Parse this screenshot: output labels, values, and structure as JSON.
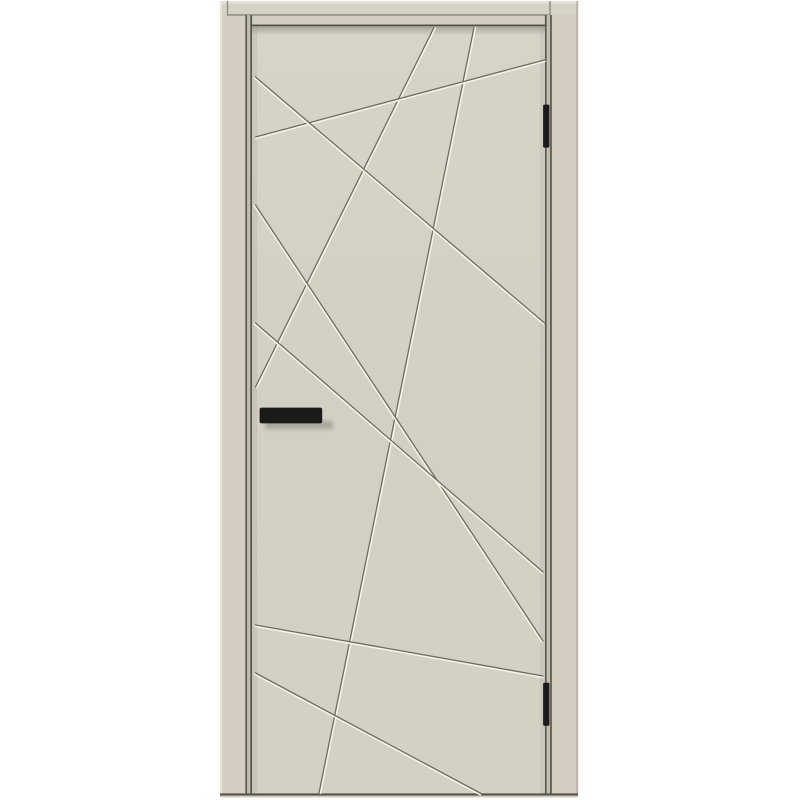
{
  "scene": {
    "background": "#ffffff",
    "palette": {
      "frame_face": "#d3cec1",
      "header_face": "#d7d2c6",
      "frame_highlight": "#e6e2d7",
      "frame_outer_shadow": "#b9b5a9",
      "joint_line": "#8d897e",
      "reveal_light": "#c0bcb0",
      "edge_dark": "#57544b",
      "panel_shade": "#96928a",
      "groove_dark": "#6f6b60",
      "groove_light": "#f6f3e9",
      "hardware_black": "#1a1a18",
      "bottom_strip": "#cec9bd"
    },
    "rects": [
      {
        "name": "background",
        "x": 0,
        "y": 0,
        "w": 800,
        "h": 800,
        "fill": "#ffffff"
      },
      {
        "name": "frame-casing-base",
        "x": 220,
        "y": 1,
        "w": 358,
        "h": 795,
        "fill": "frame_face"
      },
      {
        "name": "header-face",
        "x": 222,
        "y": 1,
        "w": 354,
        "h": 13.3,
        "fill": "header_face"
      },
      {
        "name": "frame-top-highlight",
        "x": 220,
        "y": 1,
        "w": 358,
        "h": 2.5,
        "fill": "frame_highlight"
      },
      {
        "name": "frame-left-highlight",
        "x": 220,
        "y": 1,
        "w": 2,
        "h": 795,
        "fill": "frame_highlight"
      },
      {
        "name": "frame-right-outer-shadow",
        "x": 576.3,
        "y": 1,
        "w": 1.9,
        "h": 795,
        "fill": "frame_outer_shadow"
      },
      {
        "name": "casing-joint-line",
        "x": 227,
        "y": 14.2,
        "w": 322.8,
        "h": 1.5,
        "fill": "joint_line"
      },
      {
        "name": "casing-joint-left-vertical",
        "x": 226.8,
        "y": 1,
        "w": 1.3,
        "h": 14.7,
        "fill": "joint_line"
      },
      {
        "name": "casing-joint-right-vertical",
        "x": 549.3,
        "y": 1,
        "w": 1.4,
        "h": 14.7,
        "fill": "joint_line"
      },
      {
        "name": "left-frame-stop-line",
        "x": 245.4,
        "y": 15,
        "w": 1.6,
        "h": 779,
        "fill": "edge_dark"
      },
      {
        "name": "left-reveal",
        "x": 247,
        "y": 15,
        "w": 3.3,
        "h": 779,
        "fill": "reveal_light"
      },
      {
        "name": "door-left-edge-line",
        "x": 250.3,
        "y": 15,
        "w": 1.8,
        "h": 779,
        "fill": "edge_dark"
      },
      {
        "name": "door-right-edge-line",
        "x": 544.9,
        "y": 15,
        "w": 1.8,
        "h": 779,
        "fill": "edge_dark"
      },
      {
        "name": "right-reveal",
        "x": 546.7,
        "y": 15,
        "w": 3.4,
        "h": 779,
        "fill": "reveal_light"
      },
      {
        "name": "right-frame-stop-line",
        "x": 550.1,
        "y": 15,
        "w": 1.7,
        "h": 779,
        "fill": "edge_dark"
      },
      {
        "name": "door-top-edge-line",
        "x": 250.3,
        "y": 24.5,
        "w": 296.4,
        "h": 1.9,
        "fill": "edge_dark"
      },
      {
        "name": "door-panel",
        "x": 252.1,
        "y": 26.4,
        "w": 292.8,
        "h": 767.2,
        "fill": "url(#panelGrad)"
      },
      {
        "name": "door-top-inner-shadow",
        "x": 252.1,
        "y": 26.4,
        "w": 292.8,
        "h": 9,
        "fill": "url(#topShadowGrad)"
      },
      {
        "name": "door-left-inner-shade",
        "x": 252.1,
        "y": 26.4,
        "w": 5,
        "h": 767.2,
        "fill": "panel_shade",
        "opacity": 0.18
      },
      {
        "name": "door-right-inner-shade",
        "x": 539.9,
        "y": 26.4,
        "w": 5,
        "h": 767.2,
        "fill": "panel_shade",
        "opacity": 0.15
      },
      {
        "name": "bottom-edge-line",
        "x": 220,
        "y": 793.4,
        "w": 358,
        "h": 2.2,
        "fill": "edge_dark"
      },
      {
        "name": "bottom-light-strip",
        "x": 220,
        "y": 795.6,
        "w": 358,
        "h": 1.8,
        "fill": "bottom_strip"
      }
    ],
    "groove_style": {
      "dark_width": 1.3,
      "light_width": 1.7,
      "offset": 1.4
    },
    "grooves": [
      {
        "name": "groove-a",
        "x1": 434,
        "y1": 27.5,
        "x2": 255.5,
        "y2": 387
      },
      {
        "name": "groove-b",
        "x1": 474,
        "y1": 27.5,
        "x2": 319,
        "y2": 793
      },
      {
        "name": "groove-c",
        "x1": 255.5,
        "y1": 137,
        "x2": 544.5,
        "y2": 60
      },
      {
        "name": "groove-d",
        "x1": 255.5,
        "y1": 77,
        "x2": 544.5,
        "y2": 323
      },
      {
        "name": "groove-e",
        "x1": 255.5,
        "y1": 205,
        "x2": 543,
        "y2": 641
      },
      {
        "name": "groove-f",
        "x1": 255.5,
        "y1": 323,
        "x2": 543,
        "y2": 572
      },
      {
        "name": "groove-g",
        "x1": 255.5,
        "y1": 625,
        "x2": 543,
        "y2": 676
      },
      {
        "name": "groove-h",
        "x1": 255.5,
        "y1": 673,
        "x2": 481,
        "y2": 793.5
      }
    ],
    "hinges": [
      {
        "name": "hinge-top",
        "x": 543.1,
        "y": 104.6,
        "w": 6.3,
        "h": 43,
        "rx": 1.2
      },
      {
        "name": "hinge-bottom",
        "x": 543.1,
        "y": 682.8,
        "w": 6.3,
        "h": 43,
        "rx": 1.2
      }
    ],
    "handle": {
      "name": "door-handle",
      "x": 259.6,
      "y": 407.6,
      "w": 62.6,
      "h": 15.8,
      "rx": 2,
      "shadow": {
        "x": 265,
        "y": 421,
        "w": 68,
        "h": 8,
        "opacity": 0.2
      }
    }
  }
}
